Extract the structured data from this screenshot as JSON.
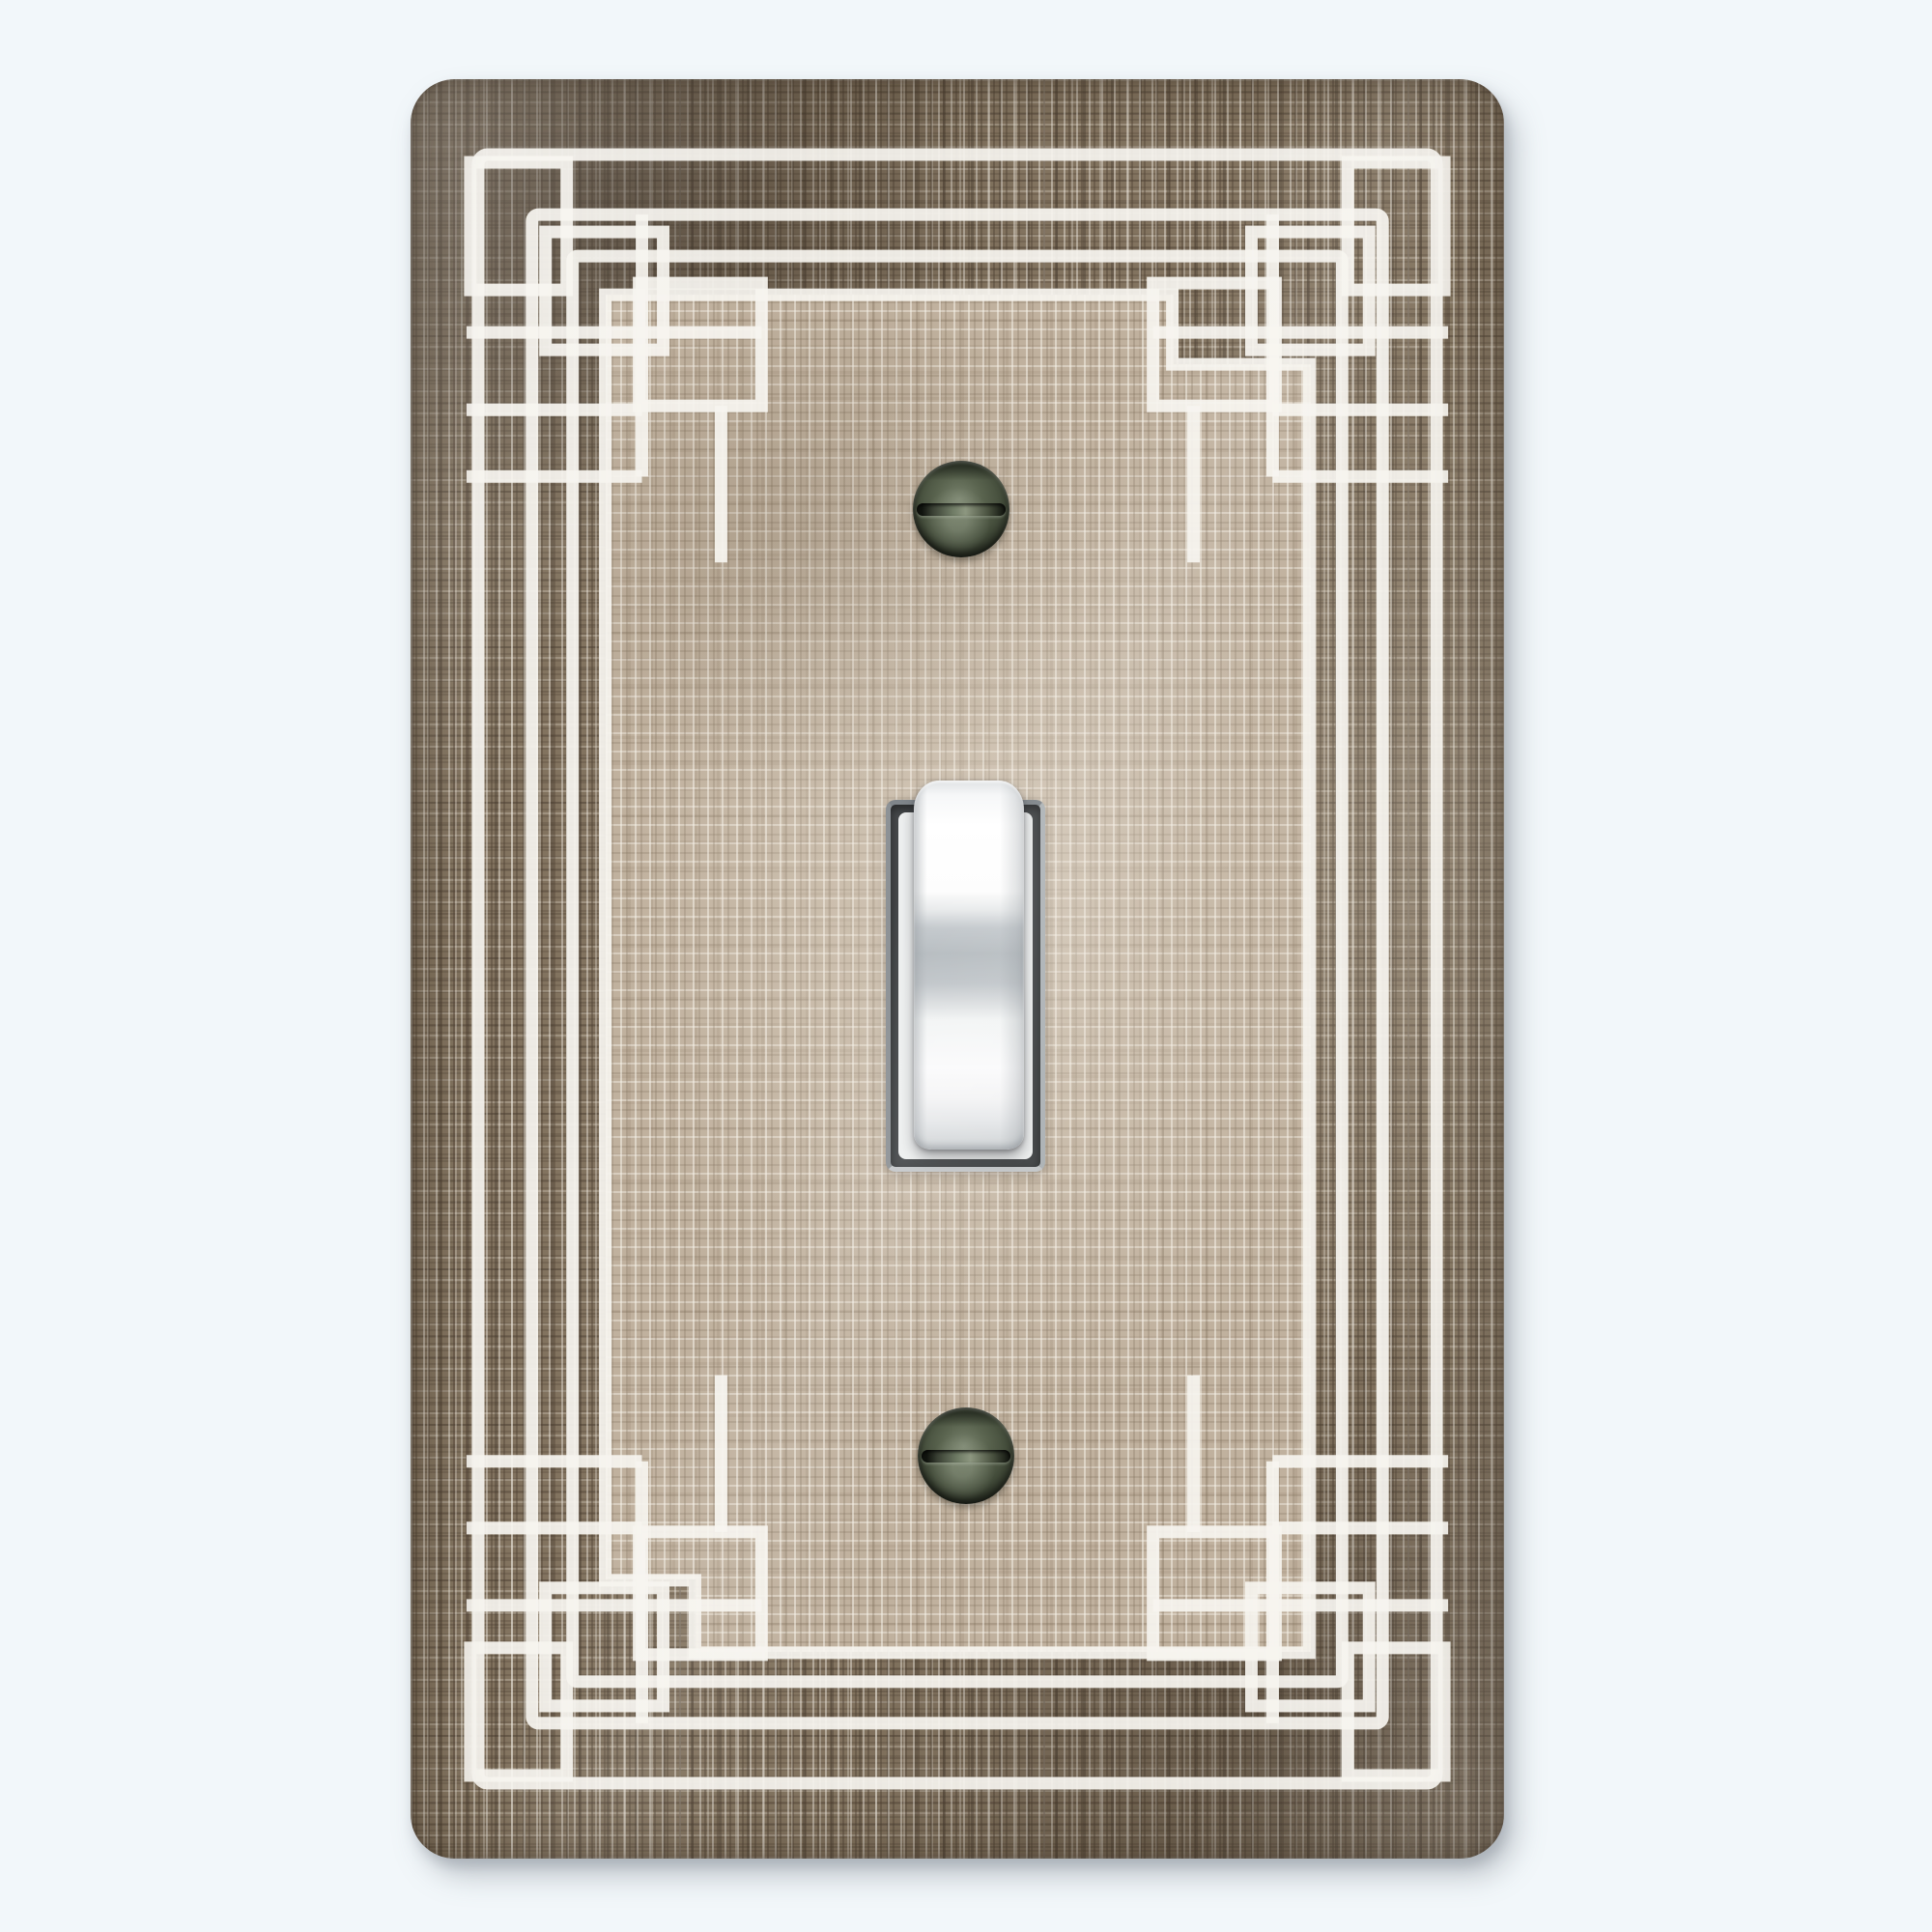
{
  "scene": {
    "type": "product-photo",
    "subject": "Decorative single-gang toggle light switch wall plate",
    "style": "Art Deco white line border with interlocking corner squares over distressed brown linen texture",
    "background_color": "#f2f7fa"
  },
  "palette": {
    "page-bg": "#f2f7fa",
    "plate-dark": "#82735f",
    "plate-darker": "#5e5040",
    "plate-light-fleck": "#f1ebe0",
    "field-base": "#c0b19e",
    "line-white": "#f6f4ef",
    "screw-body": "#4b5442",
    "screw-slot": "#171b14",
    "toggle-white": "#ffffff",
    "toggle-shade": "#bcc2c6",
    "opening-bevel": "#8b9196",
    "shadow": "#8f97a6"
  },
  "parts": {
    "plate": {
      "label": "textured wall plate",
      "border_frames": 4,
      "corner_motifs": 4,
      "texture": "distressed linen, dark brown border zone, lighter beige center field"
    },
    "toggle": {
      "label": "toggle switch lever",
      "state": "up",
      "color": "white"
    },
    "screws": [
      {
        "label": "top mounting screw",
        "slot": "horizontal",
        "finish": "dark olive gloss"
      },
      {
        "label": "bottom mounting screw",
        "slot": "horizontal",
        "finish": "dark olive gloss"
      }
    ]
  }
}
